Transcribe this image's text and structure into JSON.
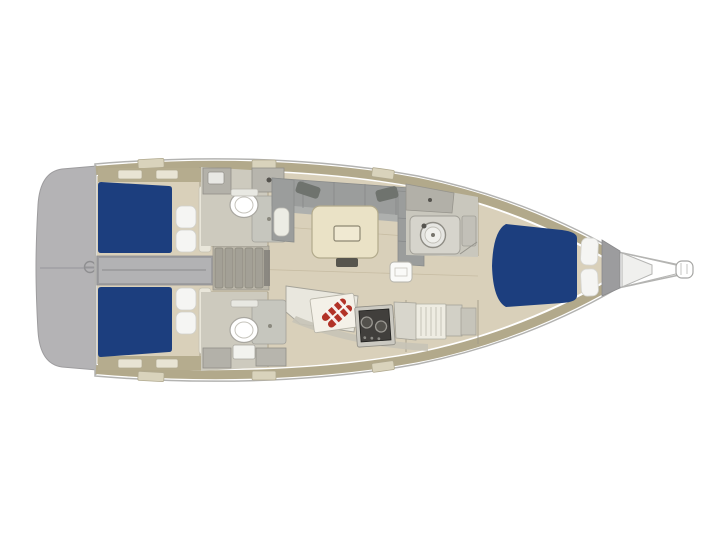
{
  "meta": {
    "description": "Sailboat interior layout floor plan, top view, stern with swim platform at left and bow sprit pointing right"
  },
  "colors": {
    "background": "#ffffff",
    "hull_fill": "#ffffff",
    "hull_stroke": "#b3b3b1",
    "deck_strip": "#b2a98b",
    "deck_hatch": "#d9d3bc",
    "floor": "#d9d0ba",
    "floor_line": "#c3b89e",
    "platform": "#b4b3b5",
    "platform_line": "#96959a",
    "berth": "#1c3e7e",
    "pillow": "#f5f5f3",
    "corridor": "#9d9d9f",
    "corridor_inner": "#b2b2b4",
    "stairs_base": "#b9b5a8",
    "stair_tread": "#a3a096",
    "sofa": "#9b9d9c",
    "sofa_seat": "#aeb0ae",
    "sofa_pillow": "#6f736e",
    "table": "#eae2c6",
    "table_stroke": "#b2aa8c",
    "table_leg": "#57554e",
    "head_floor": "#cdcabe",
    "fixture": "#b3b1a9",
    "shower": "#c6c6be",
    "toilet": "#ffffff",
    "counter": "#e9e7de",
    "counter_stroke": "#a5a399",
    "counter_face": "#c6c3b7",
    "stove": "#413f3c",
    "stove_frame": "#cbc9c1",
    "burner": "#53514c",
    "towel_red": "#b23227",
    "board": "#f4f1e8",
    "wardrobe": "#eeece2",
    "locker": "#9c9c9e",
    "wall": "#a19a88",
    "white_fixture": "#fafaf8"
  },
  "components": {
    "swim_platform": "swim-platform",
    "aft_cabin_top": "aft-double-berth-top",
    "aft_cabin_bottom": "aft-double-berth-bottom",
    "engine_compartment": "engine-compartment-corridor",
    "companionway": "companionway-stairs",
    "head_top": "aft-head-top",
    "head_bottom": "aft-head-bottom",
    "salon": "salon-u-sofa-and-table",
    "galley": "galley-with-stove",
    "forward_head": "forward-head-with-sink",
    "forward_cabin": "forward-v-berth-cabin",
    "bow": "bow-and-anchor-sprit"
  }
}
